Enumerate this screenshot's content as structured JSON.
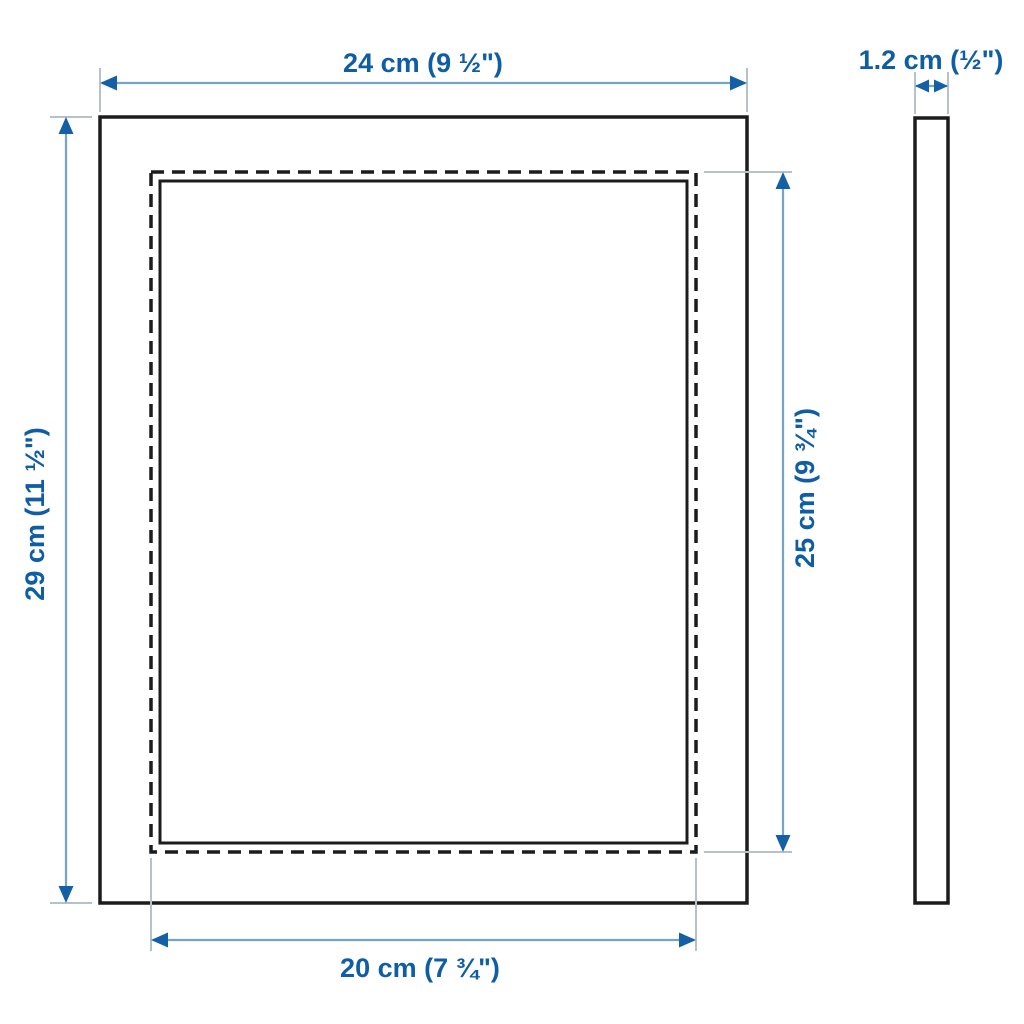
{
  "colors": {
    "bg": "#ffffff",
    "frame-line": "#1c1c1c",
    "label": "#0e5da5",
    "dim-line": "#76a3c8",
    "arrow": "#1460a6",
    "ext-line": "#b5c2cc"
  },
  "diagram": {
    "type": "product-dimension-drawing",
    "subject": "picture frame",
    "views": {
      "front": "frame front view with dashed picture opening",
      "side": "frame side profile"
    },
    "measurements": {
      "outer_width": "24 cm (9 ½\")",
      "thickness": "1.2 cm (½\")",
      "outer_height": "29 cm (11 ½\")",
      "picture_height": "25 cm (9 ¾\")",
      "picture_width": "20 cm (7 ¾\")"
    }
  }
}
